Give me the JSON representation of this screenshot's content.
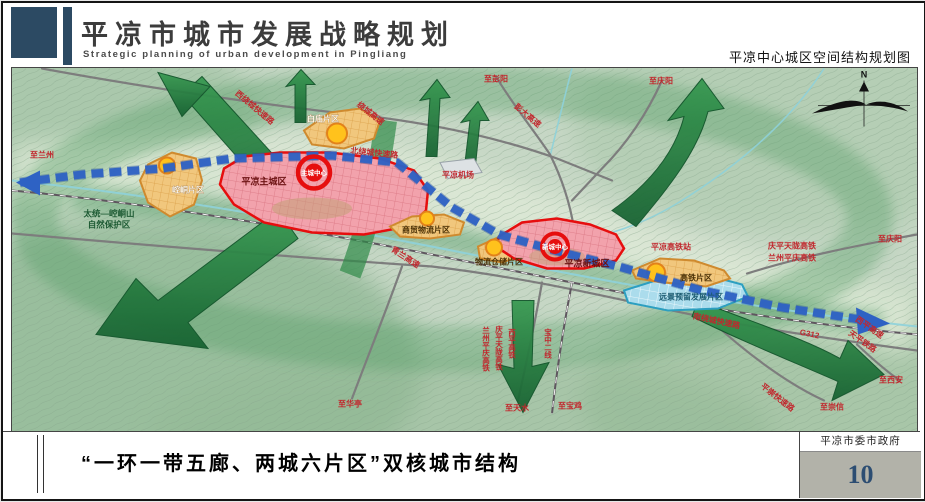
{
  "header": {
    "title": "平凉市城市发展战略规划",
    "subtitle": "Strategic planning of urban development in Pingliang",
    "map_caption": "平凉中心城区空间结构规划图"
  },
  "map": {
    "compass": "N",
    "zones": {
      "main_city": "平凉主城区",
      "new_city": "平凉新城区",
      "core_main": "主城中心",
      "core_new": "新城中心",
      "kongtong": "崆峒片区",
      "baimiao": "白庙片区",
      "trade_logistics": "商贸物流片区",
      "warehouse_logistics": "物流仓储片区",
      "hsr_district": "高铁片区",
      "reserve": "远景预留发展片区"
    },
    "nature_reserve": {
      "line1": "太统—崆峒山",
      "line2": "自然保护区"
    },
    "facilities": {
      "airport": "平凉机场",
      "hsr_station": "平凉高铁站"
    },
    "roads": {
      "west_ring": "西绕城快速路",
      "north_ring": "北绕城快速路",
      "south_ring": "南绕城快速路",
      "bypass_expwy": "绕城高速",
      "pengda_expwy": "彭大高速",
      "qinglan_expwy": "青兰高速",
      "g312": "G312",
      "xiping_expwy": "西平高速",
      "pingchong_expwy": "平崇快速路"
    },
    "railways": {
      "qingping_tianlong_hsr": "庆平天陇高铁",
      "lanzhou_pingqing_hsr": "兰州平庆高铁",
      "xiping_hsr": "西平高铁",
      "baozhong_second": "宝中二线",
      "tianping_rail": "天平铁路"
    },
    "directions": {
      "pengyang": "至彭阳",
      "qingyang": "至庆阳",
      "lanzhou": "至兰州",
      "xian": "至西安",
      "chongxin": "至崇信",
      "huating": "至华亭",
      "tianshui": "至天水",
      "baoji": "至宝鸡"
    }
  },
  "footer": {
    "slogan": "“一环一带五廊、两城六片区”双核城市结构",
    "organization": "平凉市委市政府",
    "page_number": "10"
  },
  "colors": {
    "brand": "#2c4a63",
    "core_red": "#e60e0e",
    "district_orange": "#f1c77d",
    "reserve_blue": "#abdcec",
    "axis_blue": "#2e62c4",
    "corridor_green": "#2e8a47"
  }
}
